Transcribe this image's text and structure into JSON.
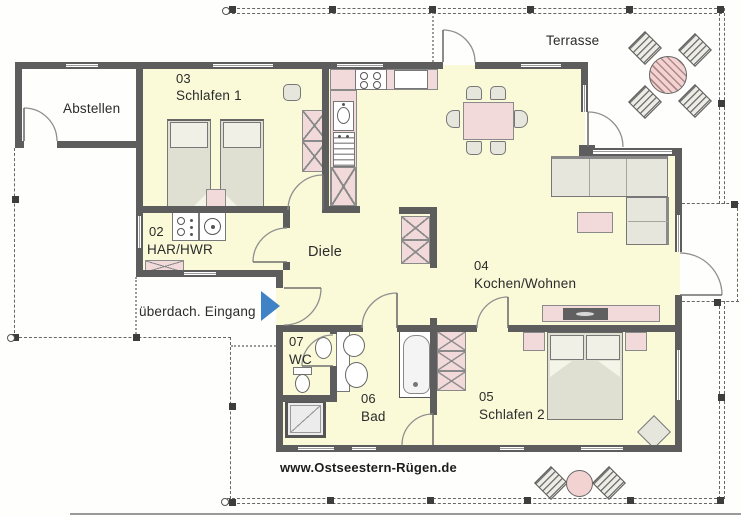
{
  "plan_type": "floor-plan",
  "labels": {
    "terrasse": "Terrasse",
    "abstellen": "Abstellen",
    "eingang": "überdach. Eingang",
    "diele": "Diele",
    "website": "www.Ostseestern-Rügen.de"
  },
  "rooms": {
    "schlafen1": {
      "number": "03",
      "name": "Schlafen 1"
    },
    "har": {
      "number": "02",
      "name": "HAR/HWR"
    },
    "kochen_wohnen": {
      "number": "04",
      "name": "Kochen/Wohnen"
    },
    "schlafen2": {
      "number": "05",
      "name": "Schlafen 2"
    },
    "bad": {
      "number": "06",
      "name": "Bad"
    },
    "wc": {
      "number": "07",
      "name": "WC"
    }
  },
  "colors": {
    "wall": "#5D5D5D",
    "floor": "#FAFAD9",
    "furniture_pink": "#F3DADA",
    "furniture_gray": "#E6E6DC",
    "entry_arrow_blue": "#3F83C6",
    "dashed_boundary": "#666666",
    "label_text": "#2B2B2B"
  }
}
